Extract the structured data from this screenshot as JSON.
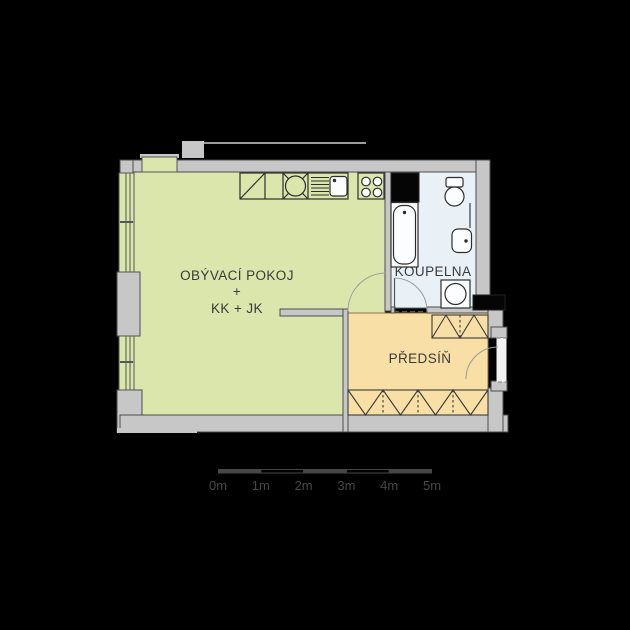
{
  "plan": {
    "type": "apartment-floor-plan",
    "rooms": {
      "living": {
        "line1": "OBÝVACÍ POKOJ",
        "line2": "+",
        "line3": "KK + JK"
      },
      "bathroom": {
        "name": "KOUPELNA"
      },
      "hall": {
        "name": "PŘEDSÍŇ"
      }
    },
    "symbols": {
      "fridge": "square-with-diagonal",
      "appliance": "square-with-x-and-inscribed-circle",
      "kitchen-sink": "basin-with-drainer-hatching",
      "stove": "four-burner-circles",
      "bathtub": "rect-with-inner-rounded-tub",
      "toilet": "tank-and-bowl",
      "washbasin": "rounded-basin",
      "washing-machine": "square-with-circle",
      "wardrobe": "zigzag-band",
      "door": "quarter-circle-arc",
      "window": "double-line-in-wall",
      "shaft": "solid-black-rect"
    }
  },
  "scale_bar": {
    "ticks": [
      "0m",
      "1m",
      "2m",
      "3m",
      "4m",
      "5m"
    ]
  },
  "colors": {
    "background": "#000000",
    "wall": "#c7c7c7",
    "wall-stroke": "#4d4d4d",
    "living": "#dbe6ad",
    "bathroom": "#e9f1f7",
    "hall": "#f8dfa6",
    "line": "#2d2d2d",
    "label": "#3a3a3a",
    "scale": "#474747",
    "shaft": "#050505",
    "fixture-fill": "#fbfdfe"
  }
}
